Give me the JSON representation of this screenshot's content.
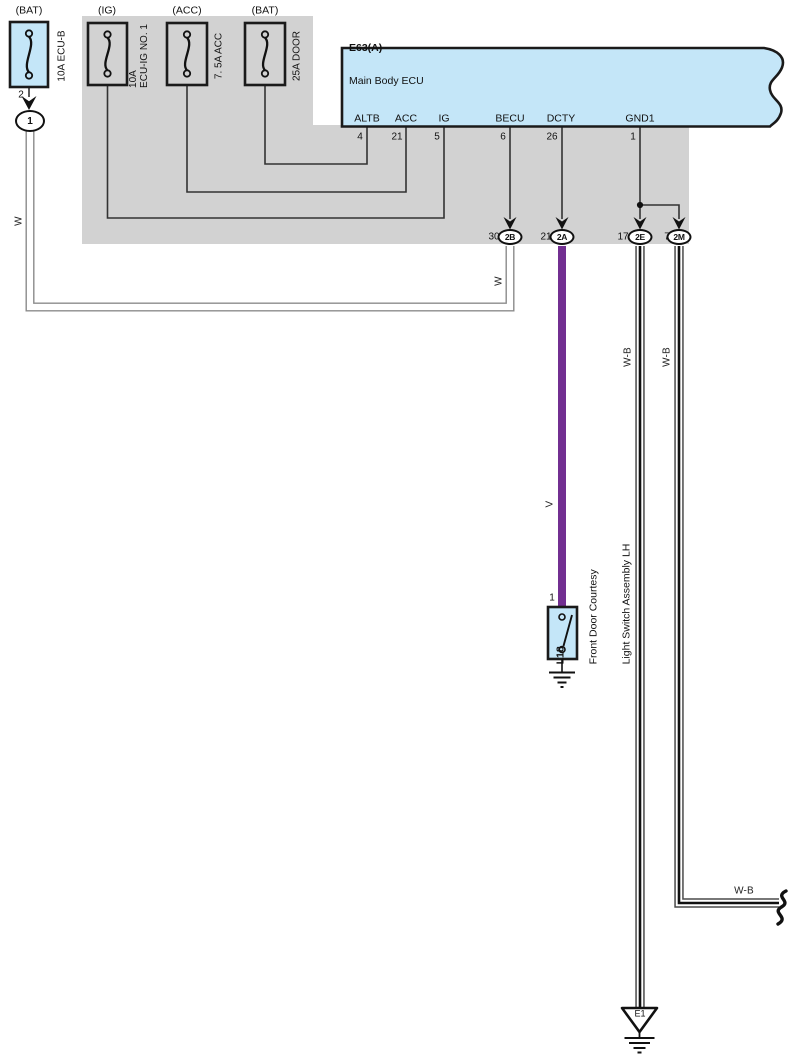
{
  "colors": {
    "component_blue": "#c4e6f8",
    "shield_gray": "#d2d2d2",
    "wire_violet": "#722f91"
  },
  "fuses": {
    "bat_main": {
      "top_label": "(BAT)",
      "name": "10A ECU-B",
      "pin_out": "2"
    },
    "ig": {
      "top_label": "(IG)",
      "name_line1": "10A",
      "name_line2": "ECU-IG NO. 1"
    },
    "acc": {
      "top_label": "(ACC)",
      "name": "7. 5A ACC"
    },
    "door": {
      "top_label": "(BAT)",
      "name": "25A DOOR"
    }
  },
  "bat_connector": {
    "label": "1"
  },
  "ecu": {
    "code": "E63(A)",
    "name": "Main Body ECU",
    "pins": [
      {
        "name": "ALTB",
        "num": "4"
      },
      {
        "name": "ACC",
        "num": "21"
      },
      {
        "name": "IG",
        "num": "5"
      },
      {
        "name": "BECU",
        "num": "6"
      },
      {
        "name": "DCTY",
        "num": "26"
      },
      {
        "name": "GND1",
        "num": "1"
      }
    ]
  },
  "connectors": [
    {
      "pin": "30",
      "id": "2B"
    },
    {
      "pin": "21",
      "id": "2A"
    },
    {
      "pin": "17",
      "id": "2E"
    },
    {
      "pin": "7",
      "id": "2M"
    }
  ],
  "wire_labels": {
    "left_w": "W",
    "right_w": "W",
    "violet_v": "V",
    "wb_2e": "W-B",
    "wb_2m": "W-B",
    "wb_bottom": "W-B"
  },
  "switch": {
    "pin": "1",
    "code": "L18",
    "name_line1": "Front Door Courtesy",
    "name_line2": "Light Switch Assembly LH"
  },
  "ground": {
    "code": "E1"
  }
}
